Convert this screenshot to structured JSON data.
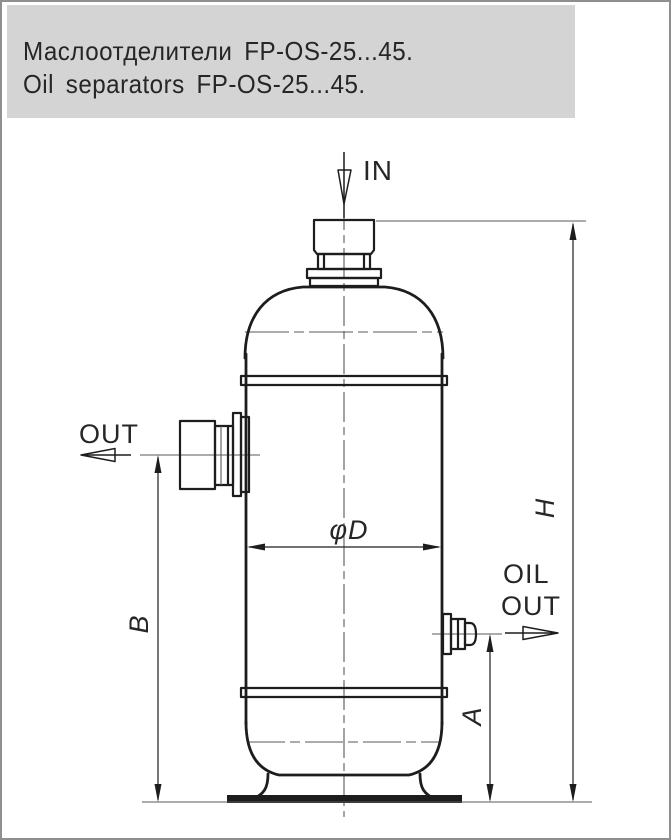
{
  "header": {
    "title_ru": "Маслоотделители FP-OS-25...45.",
    "title_en": "Oil separators FP-OS-25...45."
  },
  "diagram": {
    "labels": {
      "inlet": "IN",
      "outlet": "OUT",
      "oil_outlet_line1": "OIL",
      "oil_outlet_line2": "OUT",
      "diameter": "φD",
      "dim_b": "B",
      "dim_a": "A",
      "dim_h": "H"
    }
  },
  "colors": {
    "header_bg": "#d4d4d4",
    "line": "#1d1d1d",
    "thin_line": "#5a5a5a",
    "text": "#262626",
    "frame": "#8f8f8f"
  }
}
